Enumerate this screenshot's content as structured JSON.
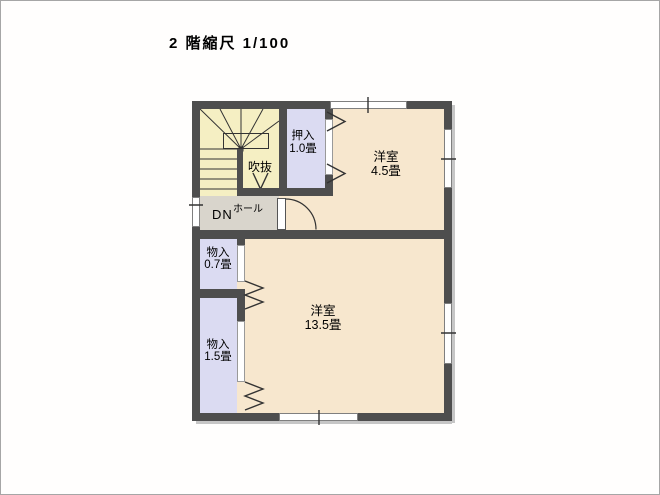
{
  "title": "2 階縮尺 1/100",
  "plan": {
    "rooms": {
      "oshiire": {
        "name": "押入",
        "area": "1.0畳"
      },
      "yoshitsu_45": {
        "name": "洋室",
        "area": "4.5畳"
      },
      "fukinuke": {
        "name": "吹抜"
      },
      "hall": {
        "dn": "DN",
        "name": "ホール"
      },
      "monoire_07": {
        "name": "物入",
        "area": "0.7畳"
      },
      "yoshitsu_135": {
        "name": "洋室",
        "area": "13.5畳"
      },
      "monoire_15": {
        "name": "物入",
        "area": "1.5畳"
      }
    },
    "colors": {
      "wall": "#4e4e4e",
      "room_floor": "#f7e7ce",
      "closet_floor": "#dbdbf2",
      "stairs_floor": "#f5efc3",
      "hall_floor": "#d9d5cc",
      "line": "#333333"
    }
  }
}
